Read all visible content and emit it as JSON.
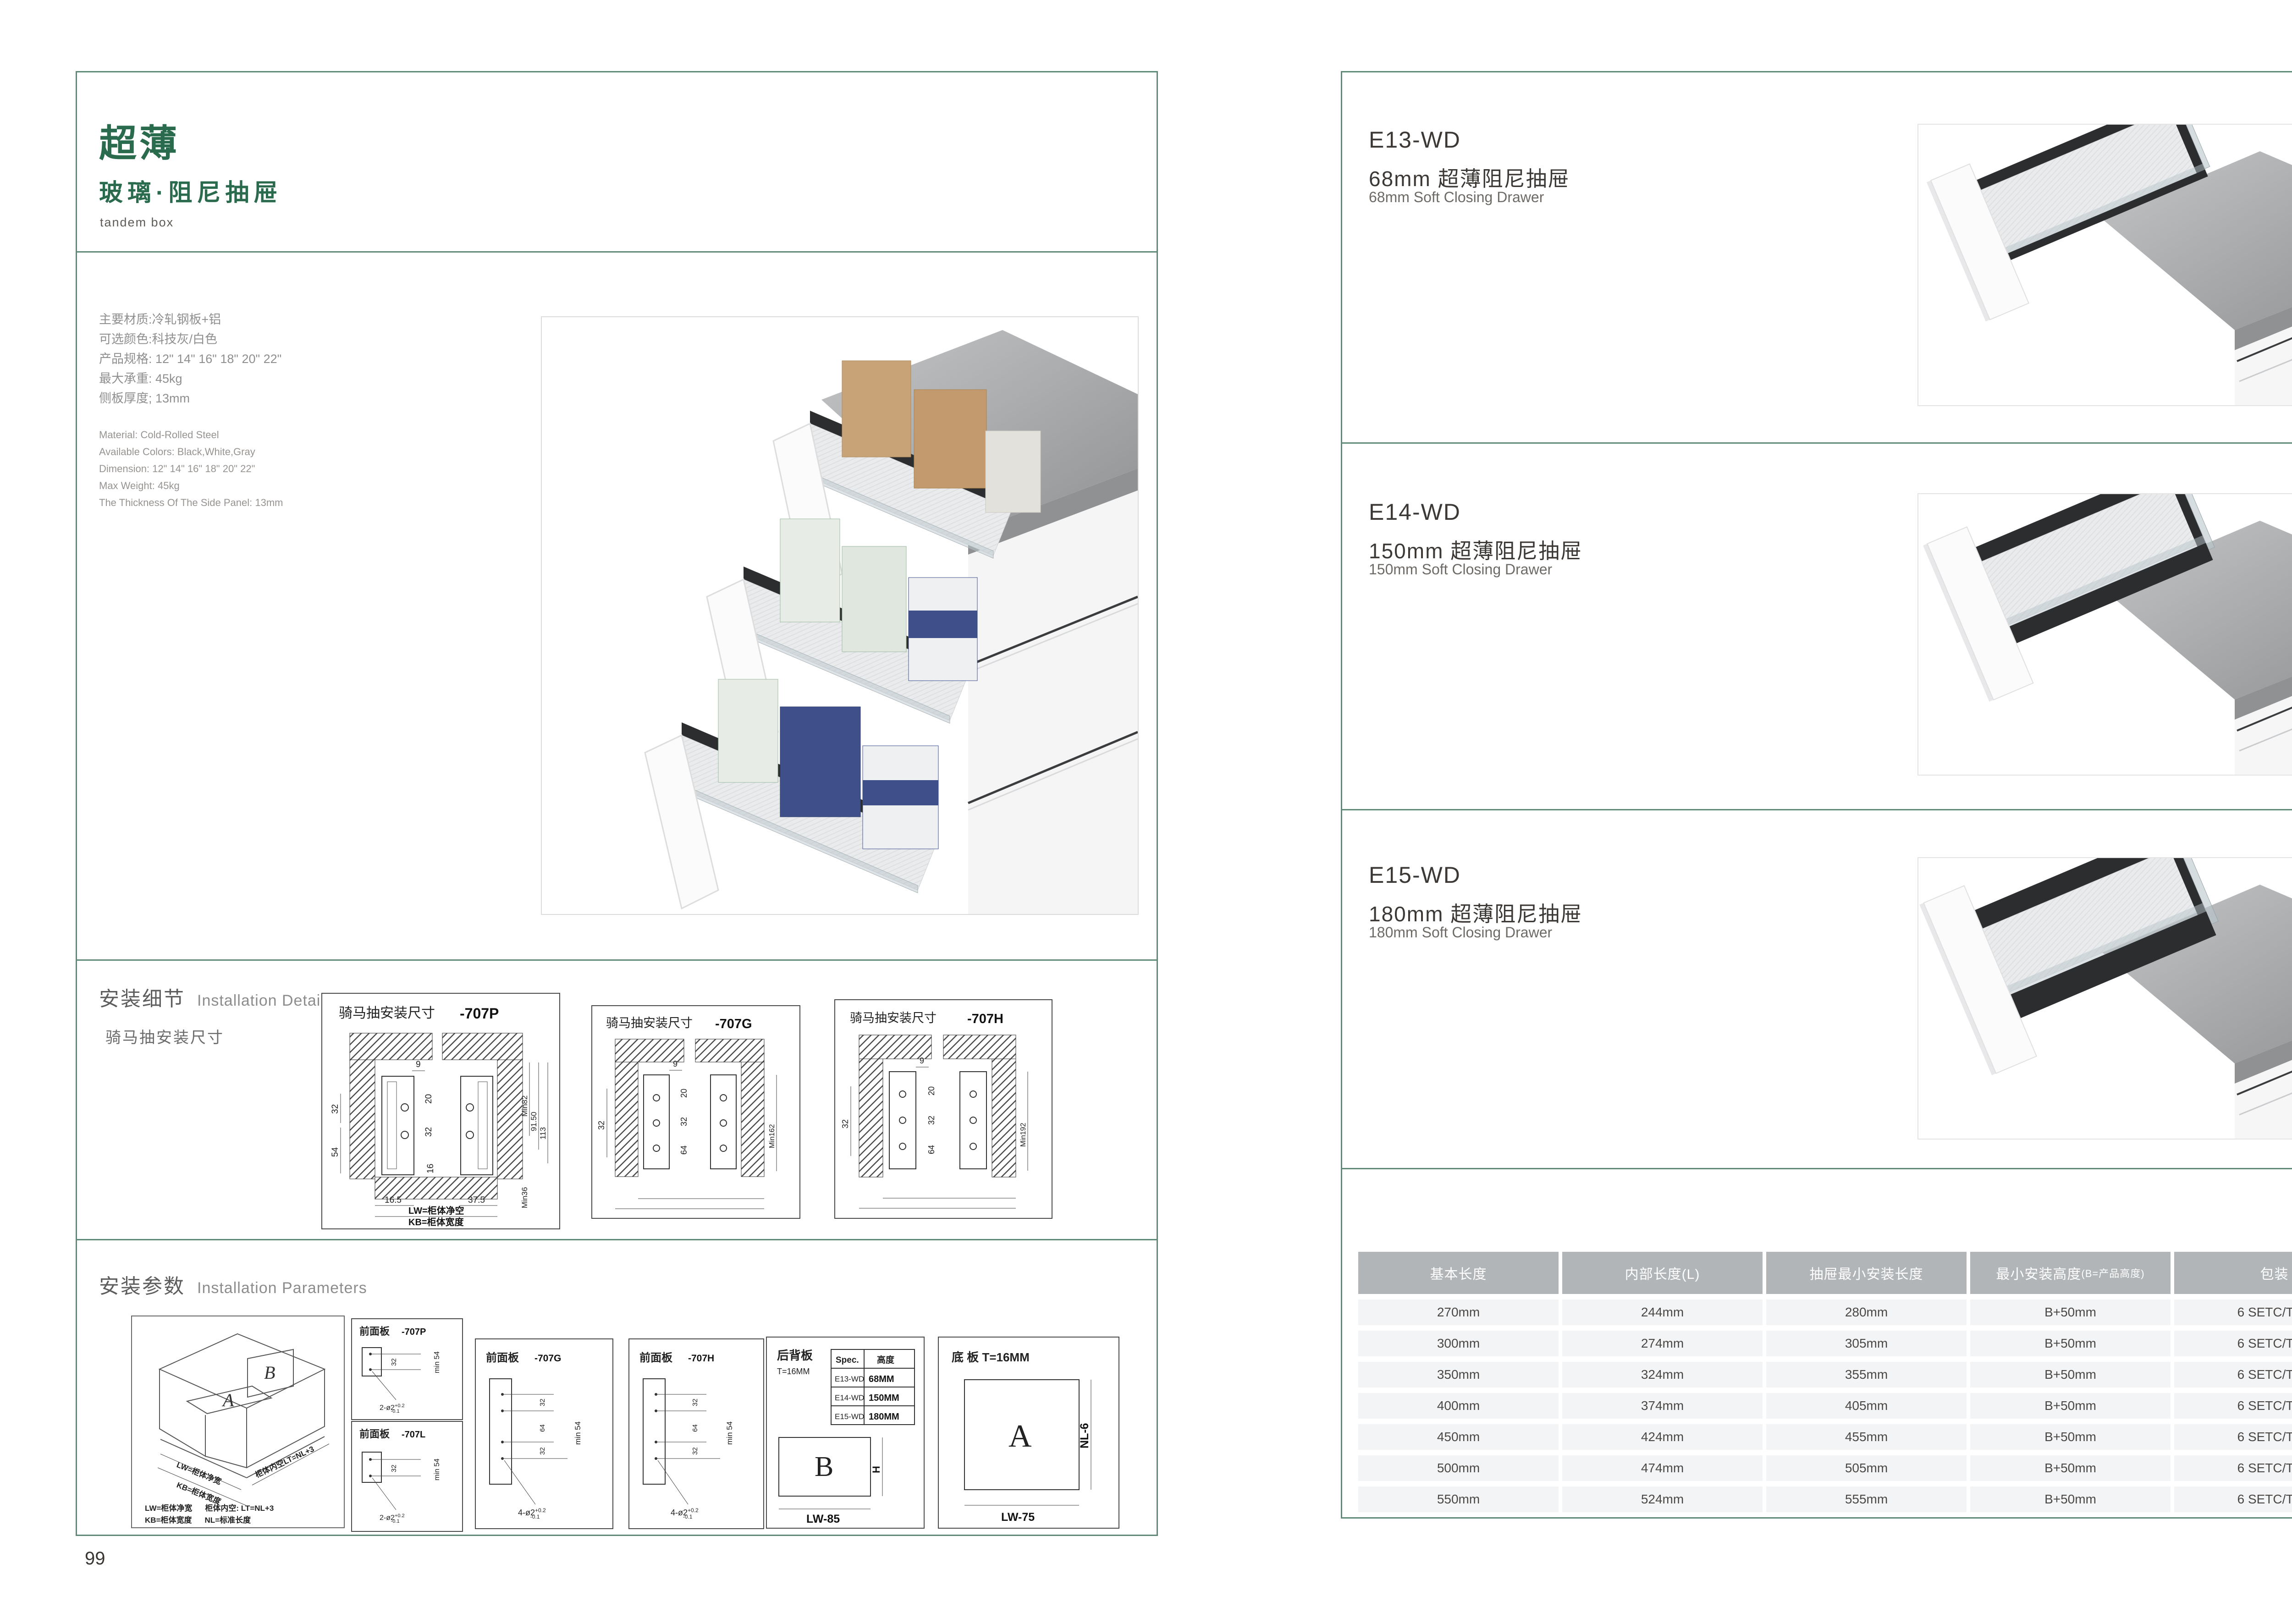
{
  "colors": {
    "accent_green": "#2a6b4d",
    "border_green": "#5d8b77",
    "table_header_bg": "#b2b5b8",
    "table_row_bg": "#f3f4f6"
  },
  "left": {
    "number": "99",
    "title": "超薄",
    "subtitle": "玻璃·阻尼抽屉",
    "tagline": "tandem box",
    "specs_cn": [
      "主要材质:冷轧钢板+铝",
      "可选颜色:科技灰/白色",
      "产品规格: 12\" 14\" 16\" 18\" 20\" 22\"",
      "最大承重: 45kg",
      "侧板厚度; 13mm"
    ],
    "specs_en": [
      "Material: Cold-Rolled Steel",
      "Available Colors: Black,White,Gray",
      "Dimension: 12\" 14\" 16\" 18\" 20\" 22\"",
      "Max Weight: 45kg",
      "The Thickness Of The Side Panel: 13mm"
    ],
    "details": {
      "heading_cn": "安装细节",
      "heading_en": "Installation Details",
      "subheading": "骑马抽安装尺寸",
      "drawings": [
        {
          "title": "骑马抽安装尺寸",
          "code": "-707P",
          "d9": "9",
          "d20": "20",
          "d32a": "32",
          "d32b": "32",
          "d54": "54",
          "d16": "16",
          "d165": "16.5",
          "d375": "37.5",
          "min": "Min82",
          "d915": "91.50",
          "d113": "113",
          "min36": "Min36",
          "lw": "LW=柜体净空",
          "kb": "KB=柜体宽度"
        },
        {
          "title": "骑马抽安装尺寸",
          "code": "-707G",
          "d9": "9",
          "d20": "20",
          "d32a": "32",
          "d64": "64",
          "d32b": "32",
          "min": "Min162"
        },
        {
          "title": "骑马抽安装尺寸",
          "code": "-707H",
          "d9": "9",
          "d20": "20",
          "d32a": "32",
          "d64": "64",
          "d32b": "32",
          "min": "Min192"
        }
      ]
    },
    "params": {
      "heading_cn": "安装参数",
      "heading_en": "Installation Parameters",
      "iso": {
        "label_a": "A",
        "label_b": "B",
        "dim_lw": "LW=柜体净宽",
        "dim_kb": "KB=柜体宽度",
        "dim_lt": "柜体内空LT=NL+3",
        "legend_l1a": "LW=柜体净宽",
        "legend_l1b": "柜体内空: LT=NL+3",
        "legend_l2a": "KB=柜体宽度",
        "legend_l2b": "NL=标准长度"
      },
      "panels": {
        "p": {
          "title": "前面板",
          "code": "-707P",
          "dim1": "32",
          "dim2": "min 54",
          "note": "2-ø2",
          "tol_up": "+0.2",
          "tol_dn": "-0.1"
        },
        "l": {
          "title": "前面板",
          "code": "-707L",
          "dim1": "32",
          "dim2": "min 54",
          "note": "2-ø2",
          "tol_up": "+0.2",
          "tol_dn": "-0.1"
        },
        "g": {
          "title": "前面板",
          "code": "-707G",
          "dim1": "32",
          "dim2": "64",
          "dim3": "32",
          "dim4": "min 54",
          "note": "4-ø2",
          "tol_up": "+0.2",
          "tol_dn": "-0.1"
        },
        "h": {
          "title": "前面板",
          "code": "-707H",
          "dim1": "32",
          "dim2": "64",
          "dim3": "32",
          "dim4": "min 54",
          "note": "4-ø2",
          "tol_up": "+0.2",
          "tol_dn": "-0.1"
        },
        "back": {
          "title": "后背板",
          "thickness": "T=16MM",
          "spec_headers": [
            "Spec.",
            "高度"
          ],
          "spec_rows": [
            [
              "E13-WD",
              "68MM"
            ],
            [
              "E14-WD",
              "150MM"
            ],
            [
              "E15-WD",
              "180MM"
            ]
          ],
          "plate": "B",
          "dim_h": "H",
          "dim_w": "LW-85"
        },
        "bottom": {
          "title": "底 板 T=16MM",
          "plate": "A",
          "dim_d": "NL-6",
          "dim_w": "LW-75"
        }
      }
    }
  },
  "right": {
    "number": "100",
    "products": [
      {
        "model": "E13-WD",
        "name_cn": "68mm 超薄阻尼抽屉",
        "name_en": "68mm Soft Closing Drawer"
      },
      {
        "model": "E14-WD",
        "name_cn": "150mm 超薄阻尼抽屉",
        "name_en": "150mm Soft Closing Drawer"
      },
      {
        "model": "E15-WD",
        "name_cn": "180mm 超薄阻尼抽屉",
        "name_en": "180mm Soft Closing Drawer"
      }
    ],
    "table": {
      "headers": [
        {
          "main": "基本长度"
        },
        {
          "main": "内部长度(L)"
        },
        {
          "main": "抽屉最小安装长度"
        },
        {
          "main": "最小安装高度",
          "sub": "(B=产品高度)"
        },
        {
          "main": "包装"
        }
      ],
      "rows": [
        [
          "270mm",
          "244mm",
          "280mm",
          "B+50mm",
          "6 SETC/TNB"
        ],
        [
          "300mm",
          "274mm",
          "305mm",
          "B+50mm",
          "6 SETC/TNB"
        ],
        [
          "350mm",
          "324mm",
          "355mm",
          "B+50mm",
          "6 SETC/TNB"
        ],
        [
          "400mm",
          "374mm",
          "405mm",
          "B+50mm",
          "6 SETC/TNB"
        ],
        [
          "450mm",
          "424mm",
          "455mm",
          "B+50mm",
          "6 SETC/TNB"
        ],
        [
          "500mm",
          "474mm",
          "505mm",
          "B+50mm",
          "6 SETC/TNB"
        ],
        [
          "550mm",
          "524mm",
          "555mm",
          "B+50mm",
          "6 SETC/TNB"
        ]
      ]
    }
  }
}
